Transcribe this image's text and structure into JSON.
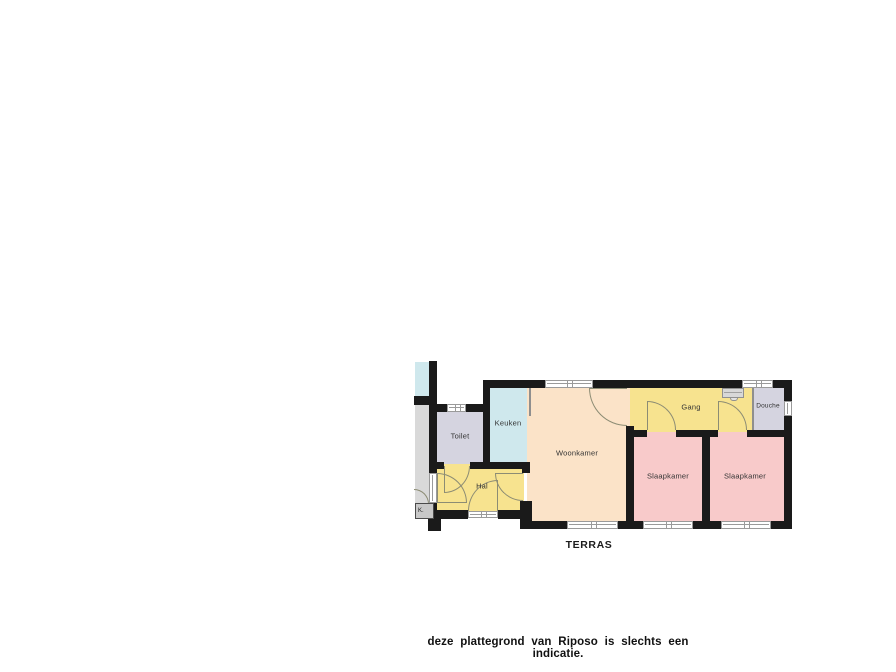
{
  "colors": {
    "wall": "#1a1a1a",
    "woonkamer": "#fbe3c8",
    "keuken": "#cfe8ed",
    "hal_gang": "#f7e38f",
    "slaapkamer": "#f8caca",
    "sanitair": "#d5d4e0",
    "buur_grijs": "#d9d9d9",
    "raam_rand": "#9a9a9a",
    "deur_lijn": "#8c8c74",
    "tekst": "#333333"
  },
  "floorplan": {
    "rooms": {
      "toilet": "Toilet",
      "keuken": "Keuken",
      "woonkamer": "Woonkamer",
      "gang": "Gang",
      "douche": "Douche",
      "slaapkamer_links": "Slaapkamer",
      "slaapkamer_rechts": "Slaapkamer",
      "hal": "Hal",
      "kast": "K."
    },
    "outdoor_label": "TERRAS"
  },
  "caption": {
    "text": "deze plattegrond van Riposo is slechts een indicatie."
  }
}
